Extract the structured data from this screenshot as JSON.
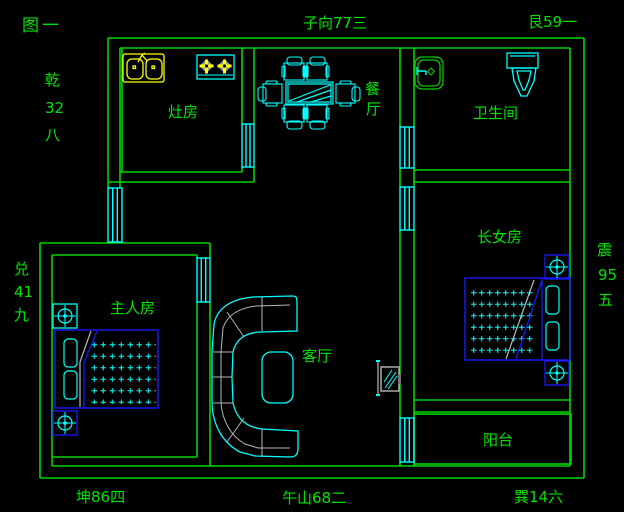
{
  "palette": {
    "background": "#000000",
    "wall_green": "#00d400",
    "text_green": "#00e400",
    "fixture_cyan": "#00ffff",
    "furniture_blue": "#1a1aff",
    "sink_yellow": "#ffff00",
    "detail_gray": "#b8b8b8"
  },
  "title": {
    "figure_label": "图一"
  },
  "compass": {
    "top_center": "子向77三",
    "top_right": "艮59一",
    "left_upper": [
      "乾",
      "32",
      "八"
    ],
    "left_lower": [
      "兑",
      "41",
      "九"
    ],
    "right_column": [
      "震",
      "95",
      "五"
    ],
    "bottom_left": "坤86四",
    "bottom_center": "午山68二",
    "bottom_right": "巽14六"
  },
  "rooms": {
    "kitchen": "灶房",
    "dining_vertical": [
      "餐",
      "厅"
    ],
    "bathroom": "卫生间",
    "eldest_daughter": "长女房",
    "master": "主人房",
    "living": "客厅",
    "balcony": "阳台"
  }
}
